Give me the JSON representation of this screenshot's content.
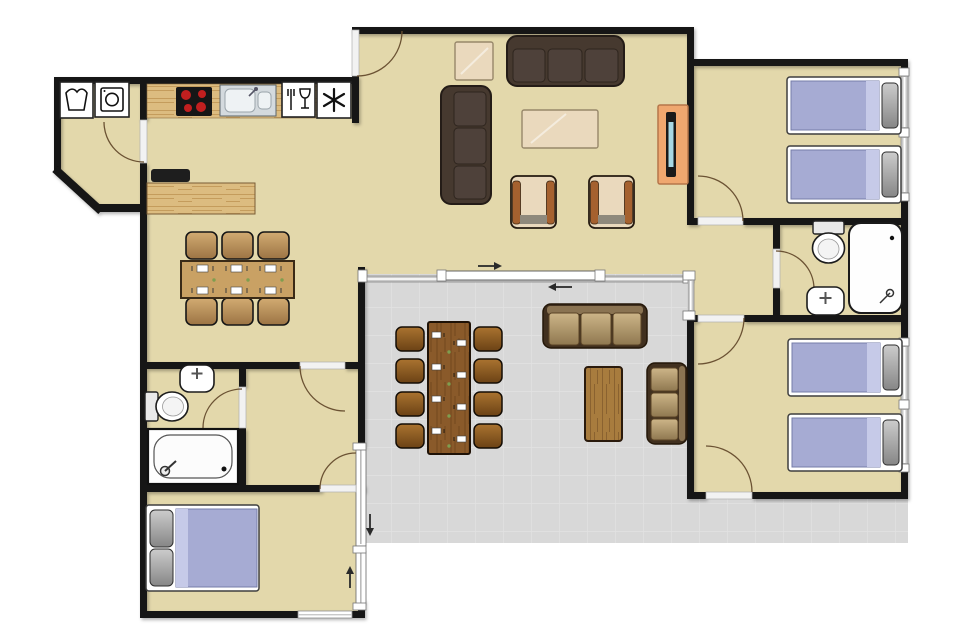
{
  "document": {
    "type": "floor-plan",
    "description": "Top-view apartment floor plan with living room, kitchen-dining area, three bedrooms, two bathrooms, hallway, utility nook and a tiled terrace with outdoor furniture",
    "background": "#ffffff"
  },
  "colors": {
    "floor": "#e3d8ab",
    "terrace": "#d8d8d8",
    "tileLine": "#e2e2e2",
    "wall": "#121212",
    "woodLight": "#dcbc80",
    "woodGrain": "#c49c5c",
    "tableTan": "#c9a164",
    "tableEdge": "#3a2a16",
    "chairTop": "#d2ab72",
    "chairBot": "#9c7444",
    "sofa": "#46392f",
    "sofaSeam": "#2e251e",
    "sofaCushion": "#4e413a",
    "cream": "#ead9bd",
    "creamEdge": "#97876a",
    "armWood": "#a5612f",
    "frontShadow": "#8f897c",
    "outFrame": "#41301f",
    "outCushTop": "#cdb588",
    "outCushBot": "#8f7850",
    "outBack": "#8a7352",
    "outWood": "#a87c3e",
    "outWoodGrain": "#8a6230",
    "terrTable": "#8a5a2a",
    "terrTableGrain": "#73481f",
    "tChairTop": "#aa7330",
    "tChairBot": "#6b4215",
    "mattress": "#a6abd3",
    "mattressEdge": "#767ca8",
    "sheetFold": "#c6cae8",
    "pillowLight": "#cccccc",
    "pillowDark": "#868686",
    "fixture": "#ffffff",
    "fixtureEdge": "#1c1c1c",
    "burner": "#c21f1f",
    "stove": "#161616",
    "steel": "#d4dade",
    "basin": "#eef2f4",
    "tvWood": "#efa76f",
    "tvWoodEdge": "#b5764a",
    "tvScreen": "#a8d8e4",
    "arc": "#6b5233",
    "glass": "#c9c9c9",
    "threshold": "#f2f2f2",
    "settingGreen": "#7f9e4f",
    "arrow": "#2a2a2a",
    "applianceDark": "#1e1e1e"
  },
  "rooms": [
    {
      "id": "utility-nook",
      "furniture": [
        "laundry-tub-symbol",
        "washing-machine-symbol",
        "hinged-door"
      ]
    },
    {
      "id": "kitchen",
      "furniture": [
        "kitchen-counter",
        "stove-4-burners",
        "double-sink",
        "cutlery-glass-symbol",
        "freezer-snowflake-symbol"
      ]
    },
    {
      "id": "dining-area",
      "furniture": [
        "sideboard",
        "countertop-appliance",
        "dining-table",
        "dining-chair x6",
        "place-setting x6"
      ]
    },
    {
      "id": "living-room",
      "furniture": [
        "three-seat-sofa",
        "three-seat-sofa-vertical",
        "square-side-table",
        "coffee-table",
        "armchair x2",
        "tv-unit",
        "entrance-door",
        "sliding-glass-wall"
      ]
    },
    {
      "id": "hallway",
      "furniture": [
        "glazed-panel",
        "door-to-bathroom"
      ]
    },
    {
      "id": "bedroom-north-east",
      "furniture": [
        "single-bed x2",
        "window x2",
        "hinged-door"
      ]
    },
    {
      "id": "bathroom-east",
      "furniture": [
        "toilet",
        "washbasin",
        "shower-cabin",
        "hinged-door"
      ]
    },
    {
      "id": "bedroom-south-east",
      "furniture": [
        "single-bed x2",
        "window x2",
        "hinged-door x2"
      ]
    },
    {
      "id": "bathroom-west",
      "furniture": [
        "washbasin",
        "toilet",
        "bathtub",
        "hinged-door"
      ]
    },
    {
      "id": "bedroom-south-west",
      "furniture": [
        "double-bed",
        "window",
        "sliding-door",
        "hinged-door"
      ]
    },
    {
      "id": "terrace",
      "furniture": [
        "outdoor-dining-table",
        "outdoor-chair x8",
        "outdoor-sofa x2",
        "outdoor-coffee-table",
        "slide-direction-arrow x4",
        "tiled-floor"
      ]
    }
  ],
  "icons": [
    "laundry-tub-icon",
    "washing-machine-icon",
    "stove-icon",
    "sink-icon",
    "cutlery-glass-icon",
    "snowflake-icon",
    "toilet-icon",
    "washbasin-icon",
    "shower-icon",
    "bathtub-icon",
    "tv-icon",
    "arrow-right-icon",
    "arrow-left-icon",
    "arrow-down-icon",
    "arrow-up-icon"
  ]
}
